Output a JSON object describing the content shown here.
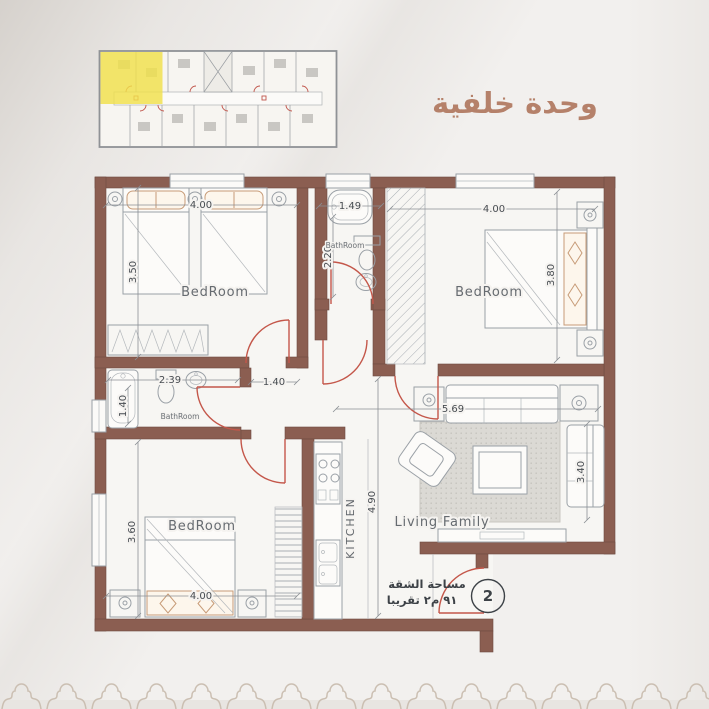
{
  "title": "وحدة خلفية",
  "plan": {
    "rooms": {
      "bedroom_top_left": {
        "label": "BedRoom",
        "width_m": "4.00",
        "depth_m": "3.50"
      },
      "bathroom_top": {
        "label": "BathRoom",
        "width_m": "1.49",
        "depth_m": "2.20"
      },
      "bedroom_top_right": {
        "label": "BedRoom",
        "width_m": "4.00",
        "depth_m": "3.80"
      },
      "bathroom_left": {
        "label": "BathRoom",
        "width_m": "2.39",
        "depth_m": "1.40"
      },
      "hallway": {
        "width_m": "1.40"
      },
      "bedroom_bottom_left": {
        "label": "BedRoom",
        "width_m": "4.00",
        "depth_m": "3.60"
      },
      "kitchen": {
        "label": "KITCHEN",
        "depth_m": "4.90"
      },
      "living_family": {
        "label": "Living Family",
        "width_m": "5.69",
        "depth_m": "3.40"
      }
    },
    "entrance": {
      "unit_number": "2",
      "area_note_line1": "مساحة الشقة",
      "area_note_line2": "٩١ م٢ تقريبا"
    }
  },
  "colors": {
    "wall": "#8b5e51",
    "door_arc": "#c4574a",
    "highlight_unit": "#f0e14b",
    "title_text": "#b5816a",
    "background": "#f2f0ee"
  }
}
